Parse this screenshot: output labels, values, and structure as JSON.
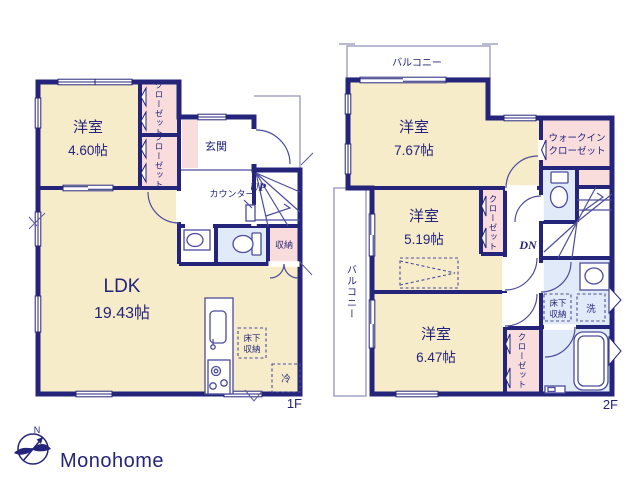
{
  "colors": {
    "wall": "#24247a",
    "room_fill": "#f6ecca",
    "closet_fill": "#f9dddd",
    "wet_fill": "#e0eaf8",
    "fixture_line": "#4c4c9c",
    "balcony_line": "#9595bb",
    "logo_text_color": "#c9c9c9"
  },
  "floor1": {
    "label": "1F",
    "west_room": {
      "name": "洋室",
      "size": "4.60帖"
    },
    "ldk": {
      "name": "LDK",
      "size": "19.43帖"
    },
    "entrance_label": "玄関",
    "counter_label": "カウンター",
    "stairs_label": "UP",
    "closet_upper": "クローゼット",
    "closet_lower": "クローゼット",
    "storage_label": "収納",
    "underfloor_line1": "床下",
    "underfloor_line2": "収納",
    "fridge_label": "冷"
  },
  "floor2": {
    "label": "2F",
    "balcony_top": "バルコニー",
    "balcony_left": "バルコニー",
    "room_a": {
      "name": "洋室",
      "size": "7.67帖"
    },
    "room_b": {
      "name": "洋室",
      "size": "5.19帖"
    },
    "room_c": {
      "name": "洋室",
      "size": "6.47帖"
    },
    "wic_line1": "ウォークイン",
    "wic_line2": "クローゼット",
    "closet_b": "クローゼット",
    "closet_c": "クローゼット",
    "stairs_label": "DN",
    "underfloor_line1": "床下",
    "underfloor_line2": "収納",
    "wash_label": "洗"
  },
  "logo": {
    "text": "Monohome",
    "compass_n": "N"
  }
}
